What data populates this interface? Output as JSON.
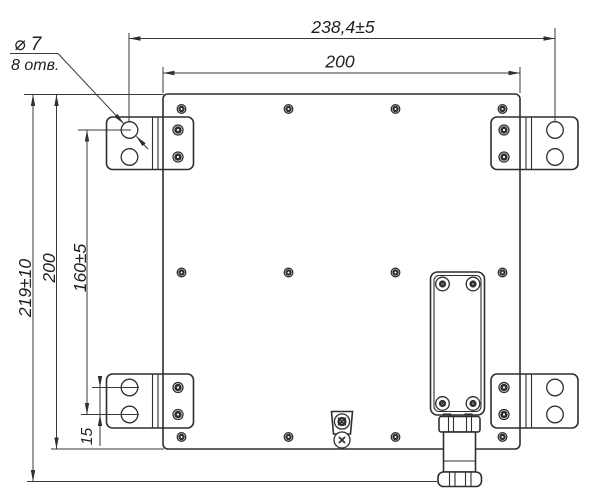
{
  "drawing": {
    "kind": "mounting-plate-technical-drawing",
    "colors": {
      "line": "#2f2f2f",
      "dimension_line": "#3a3a3a",
      "background": "#ffffff"
    },
    "dimensions": {
      "overall_width": "238,4±5",
      "plate_width": "200",
      "overall_height": "219±10",
      "plate_height": "200",
      "hole_span_vertical": "160±5",
      "hole_pitch": "15"
    },
    "hole_callout": {
      "diameter": "⌀ 7",
      "count": "8 отв."
    }
  }
}
